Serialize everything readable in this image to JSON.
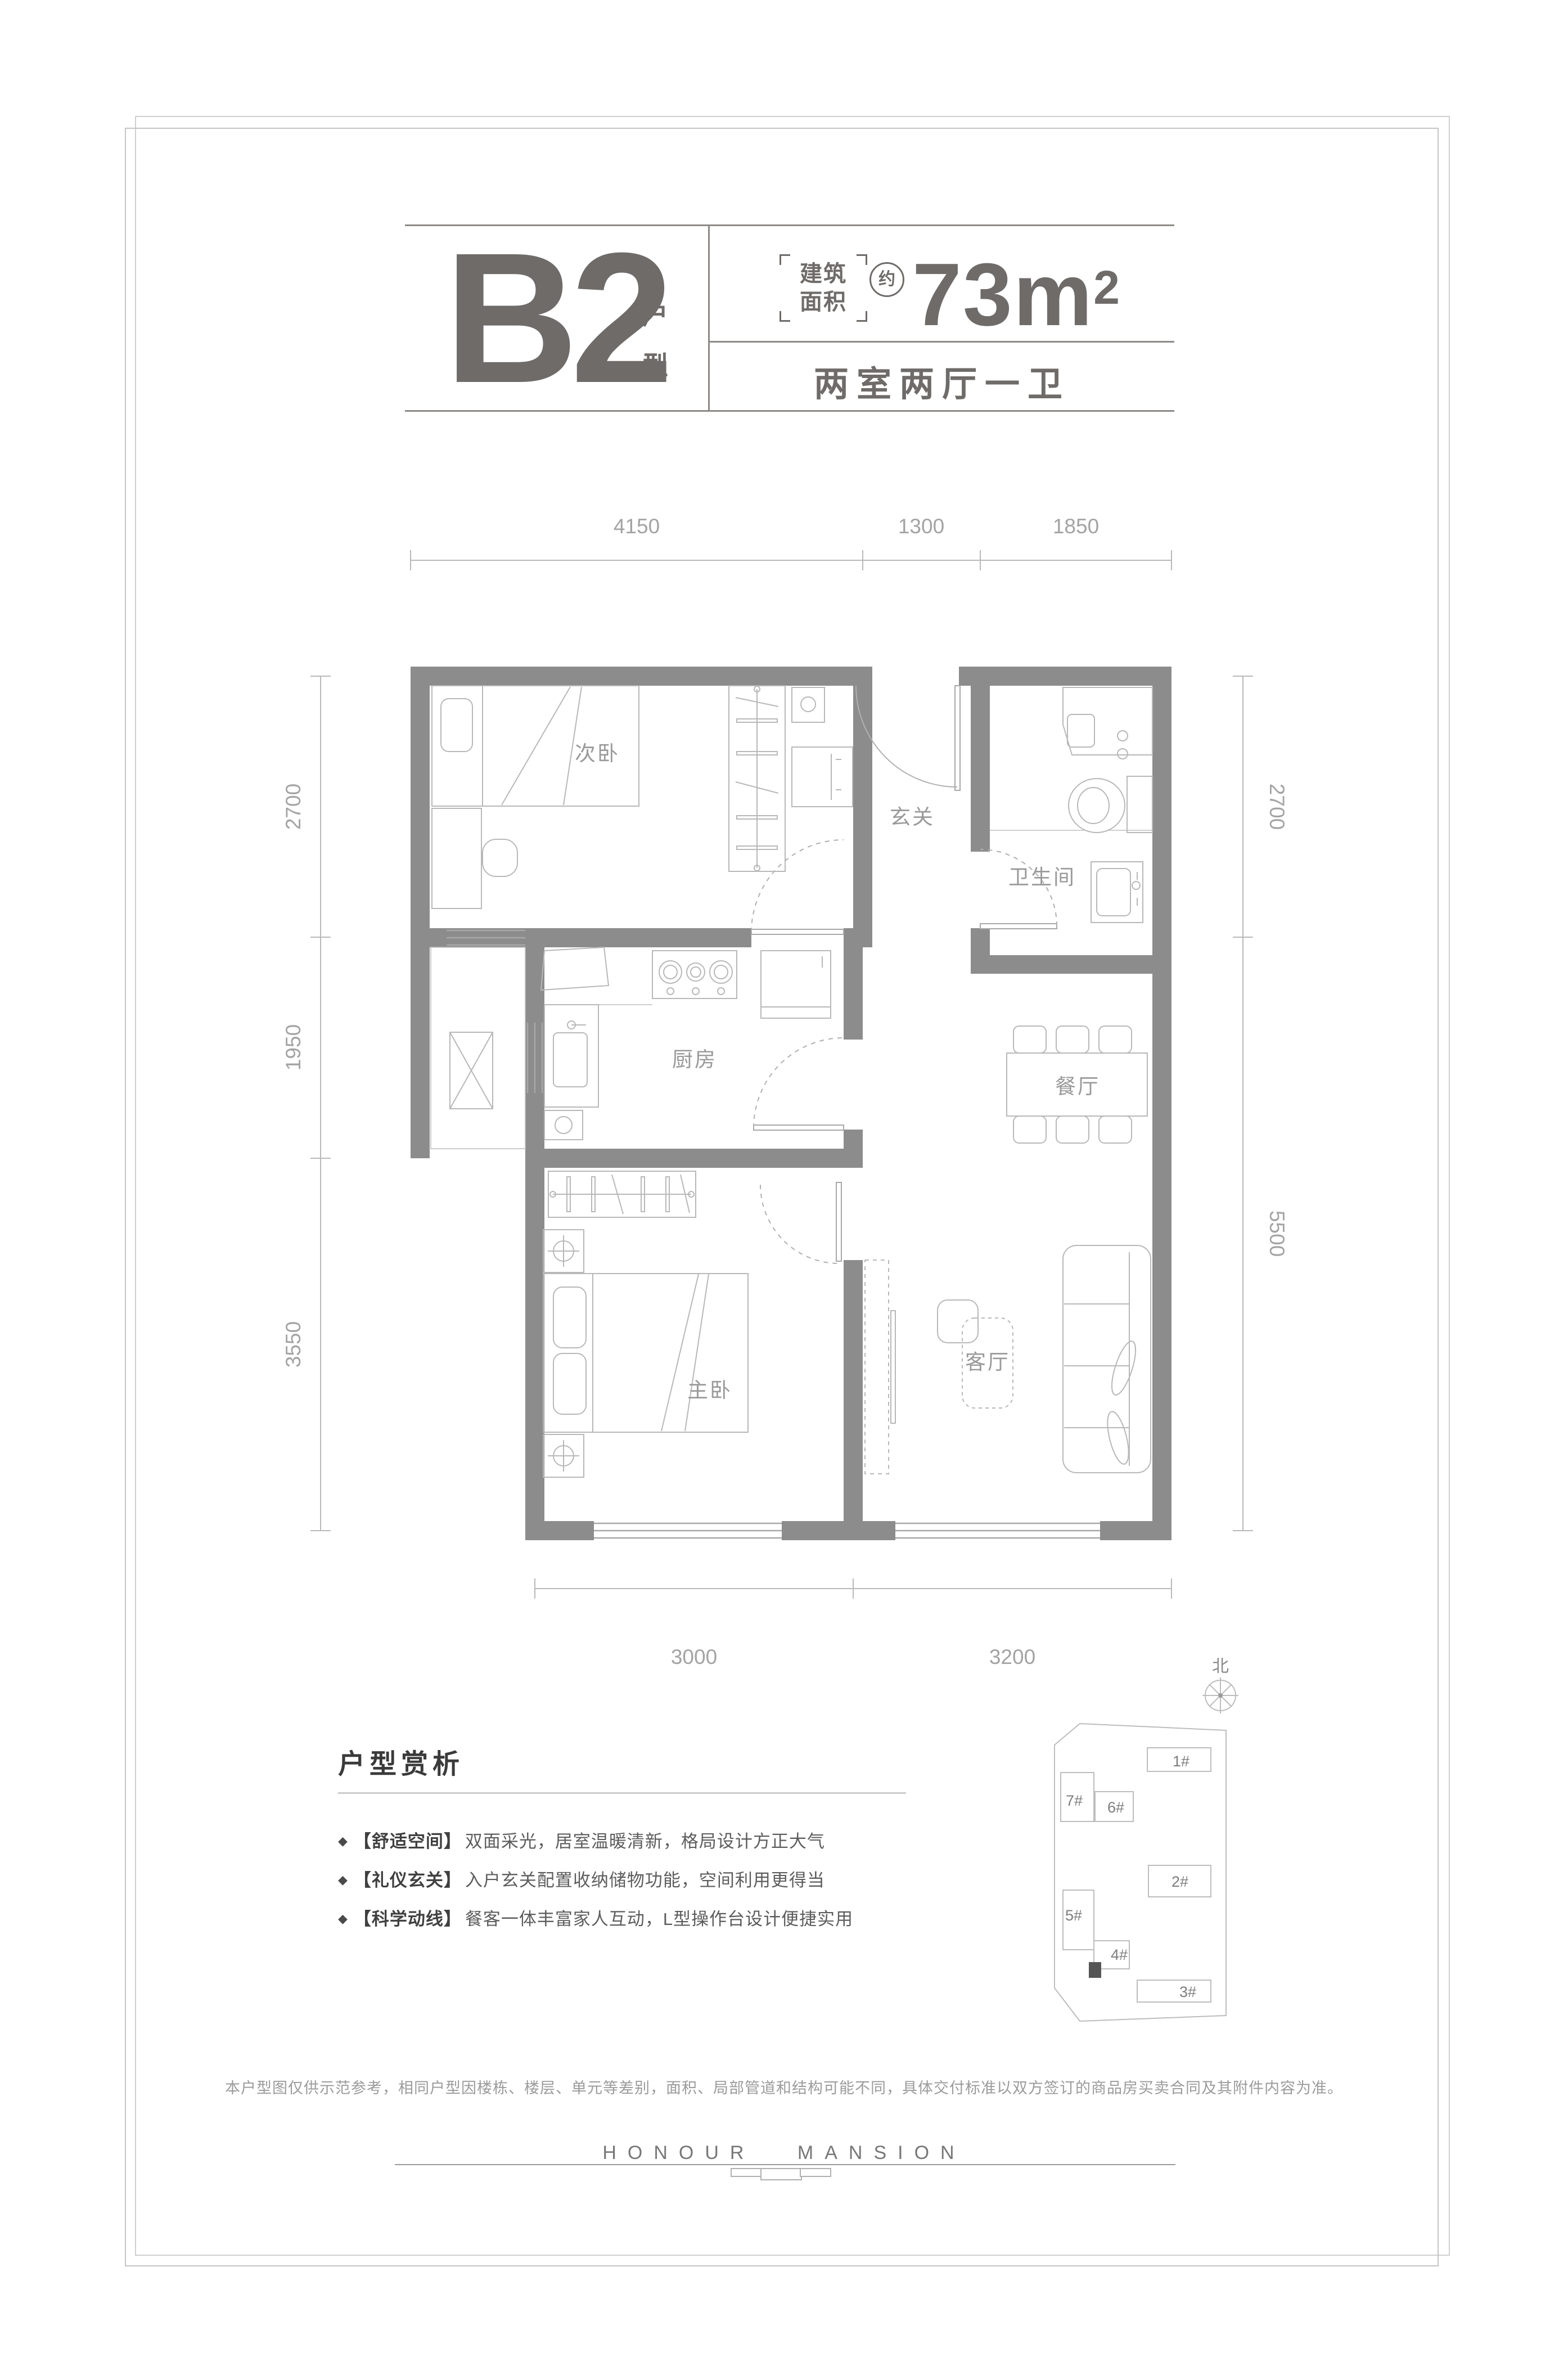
{
  "header": {
    "unit_code": "B2",
    "unit_suffix_1": "户",
    "unit_suffix_2": "型",
    "area_tag_line1": "建筑",
    "area_tag_line2": "面积",
    "area_approx": "约",
    "area_value": "73m",
    "area_sup": "2",
    "layout_summary": "两室两厅一卫"
  },
  "floor_plan": {
    "rooms": {
      "bedroom2": "次卧",
      "foyer": "玄关",
      "bathroom": "卫生间",
      "kitchen": "厨房",
      "dining": "餐厅",
      "master": "主卧",
      "living": "客厅"
    },
    "dims": {
      "top": [
        "4150",
        "1300",
        "1850"
      ],
      "left": [
        "2700",
        "1950",
        "3550"
      ],
      "right": [
        "2700",
        "5500"
      ],
      "bottom": [
        "3000",
        "3200"
      ]
    }
  },
  "site_plan": {
    "north_label": "北",
    "buildings": [
      "1#",
      "7#",
      "6#",
      "2#",
      "5#",
      "4#",
      "3#"
    ]
  },
  "analysis": {
    "title": "户型赏析",
    "marker": "◆",
    "bullets": [
      {
        "tag": "【舒适空间】",
        "text": "双面采光，居室温暖清新，格局设计方正大气"
      },
      {
        "tag": "【礼仪玄关】",
        "text": "入户玄关配置收纳储物功能，空间利用更得当"
      },
      {
        "tag": "【科学动线】",
        "text": "餐客一体丰富家人互动，L型操作台设计便捷实用"
      }
    ]
  },
  "footer": {
    "disclaimer": "本户型图仅供示范参考，相同户型因楼栋、楼层、单元等差别，面积、局部管道和结构可能不同，具体交付标准以双方签订的商品房买卖合同及其附件内容为准。",
    "brand": "HONOUR MANSION"
  },
  "colors": {
    "text_dark": "#6e6b69",
    "wall_gray": "#8c8c8c",
    "thin_line": "#b8b8b8",
    "label_gray": "#9a9a9a",
    "highlight_building": "#555555"
  }
}
